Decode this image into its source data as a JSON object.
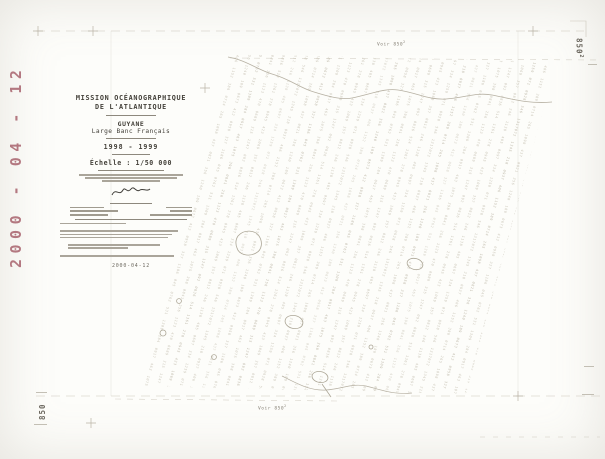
{
  "stamp": {
    "text": "2000 - 04 - 12"
  },
  "title_block": {
    "org_line1": "MISSION OCÉANOGRAPHIQUE",
    "org_line2": "DE L'ATLANTIQUE",
    "region": "GUYANE",
    "area": "Large Banc Français",
    "campaign_years": "1998 - 1999",
    "scale": "Échelle : 1/50 000",
    "issue_date": "2000-04-12"
  },
  "margin_notes": {
    "top": "Voir 850",
    "top_sup": "2",
    "bottom": "Voir 850",
    "bottom_sup": "2"
  },
  "corner_refs": {
    "top_right": "850",
    "top_right_sup": "2",
    "bottom_left": "850"
  },
  "colors": {
    "stamp": "#a55d68",
    "track_ink": "#c9c4b6",
    "frame_ink": "#c2bdb0",
    "paper": "#fdfdfa"
  },
  "texture": {
    "glyphs": "072 1345 218 0937 406 1152 389 0714 265 1098 437 0821 356 1240 189 0673 412 0958 327 1186 045 0762 531 1309 284 0917 463 1075 398 0841 256 1123 470 0689 315 1247 092 0836 514 1361 278 0945 423 1069 357 0812 246 1138 485 0697 334 1259 071 0928 546 1317"
  }
}
